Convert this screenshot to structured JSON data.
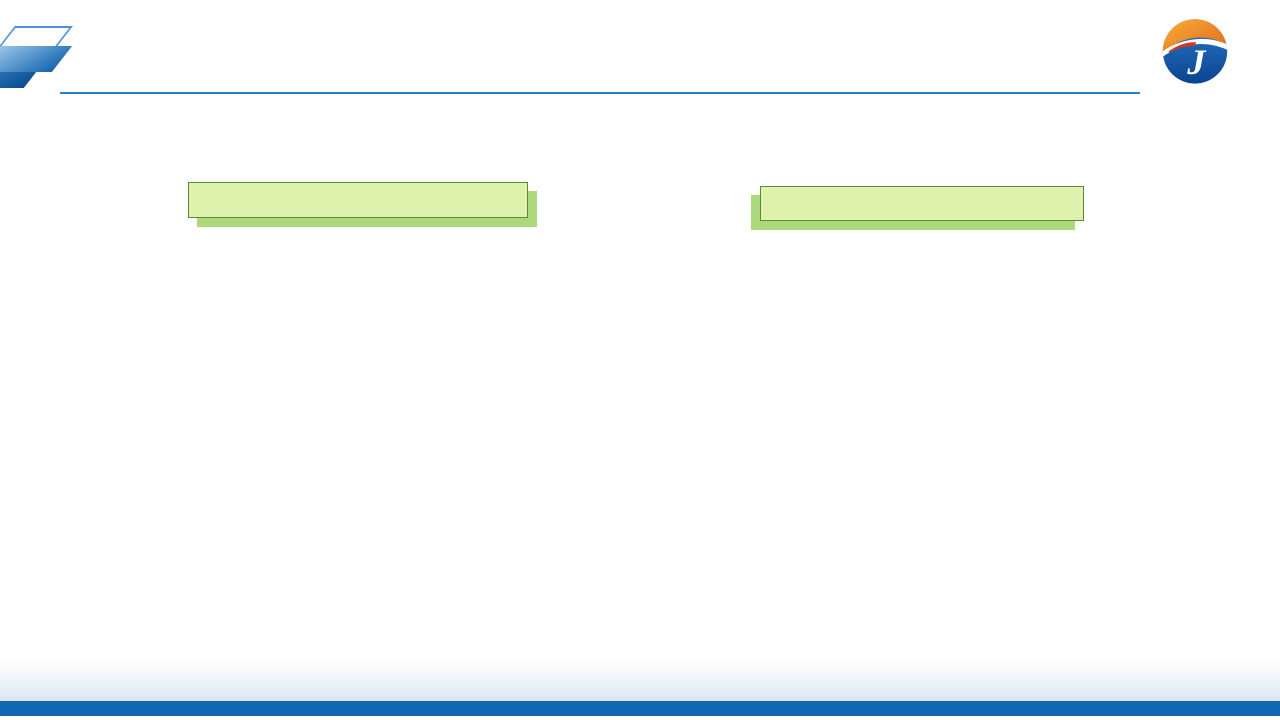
{
  "slide": {
    "title": "机房面积节省>30%"
  },
  "plans": {
    "left": {
      "header": "常规房间级精密空调机房规划平面",
      "ac_zone_top": "空调区域",
      "ac_zone_bottom": "空调区域",
      "ac_unit": "空调",
      "it_zone_line1": "机房IT设",
      "it_zone_line2": "备区 域",
      "window_code": "C3024",
      "room_power_line1": "配电",
      "room_power_line2": "配线",
      "room_lobby": "前室",
      "axis_labels": [
        "11",
        "12",
        "13",
        "14",
        "15"
      ],
      "dim_top": "3600",
      "dim_bottom": "8400",
      "dim_right_end": [
        "7800",
        "2600",
        "1900"
      ]
    },
    "right": {
      "header": "应用热管背板的机房规划平面",
      "added_it_top": "增加的机房IT设备",
      "added_it_bottom": "增加的机房IT设备",
      "it_zone_line1": "机房IT设",
      "it_zone_line2": "备区 域",
      "ac_unit": "空调",
      "window_code": "C3024",
      "room_power_line1": "配电",
      "room_power_line2": "配线",
      "room_lobby": "前室",
      "axis_labels": [
        "11",
        "12",
        "13",
        "14",
        "15"
      ],
      "dim_top": "3600",
      "dim_bottom": "8400",
      "dim_right_end": [
        "7800",
        "2600",
        "1900"
      ]
    }
  },
  "colors": {
    "title_blue": "#0b63b0",
    "green_fill": "#def2ae",
    "green_shadow": "#abd97b",
    "yellow_fill": "#fdf154",
    "yellow_border": "#ecc515",
    "orange_label": "#e8500d",
    "blue_fill": "#a8dbf0",
    "blue_border": "#2aa1d8",
    "band_fill": "#cdeaf8",
    "band_border": "#1b66c0",
    "red_label": "#d22722",
    "teal_block": "#143e4c",
    "footer_bar": "#1068b3"
  }
}
